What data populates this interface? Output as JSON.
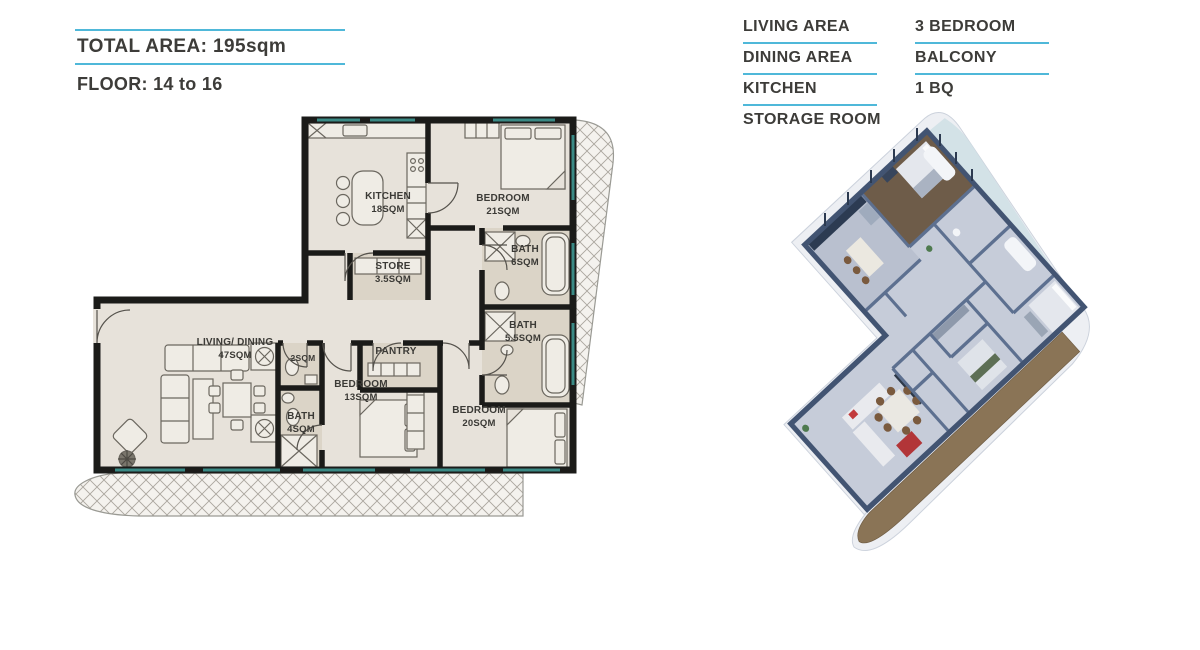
{
  "header": {
    "total_area": "TOTAL AREA: 195sqm",
    "floor": "FLOOR: 14 to 16"
  },
  "legend": {
    "column1": [
      "LIVING AREA",
      "DINING AREA",
      "KITCHEN",
      "STORAGE ROOM"
    ],
    "column2": [
      "3 BEDROOM",
      "BALCONY",
      "1 BQ"
    ]
  },
  "floorplan": {
    "rooms": [
      {
        "id": "kitchen",
        "name": "KITCHEN",
        "area": "18SQM"
      },
      {
        "id": "bedroom-1",
        "name": "BEDROOM",
        "area": "21SQM"
      },
      {
        "id": "store",
        "name": "STORE",
        "area": "3.5SQM"
      },
      {
        "id": "bath-1",
        "name": "BATH",
        "area": "6SQM"
      },
      {
        "id": "bath-2",
        "name": "BATH",
        "area": "5.5SQM"
      },
      {
        "id": "living-dining",
        "name": "LIVING/ DINING",
        "area": "47SQM"
      },
      {
        "id": "wc",
        "name": "2SQM",
        "area": ""
      },
      {
        "id": "bath-3",
        "name": "BATH",
        "area": "4SQM"
      },
      {
        "id": "pantry",
        "name": "PANTRY",
        "area": ""
      },
      {
        "id": "bedroom-2",
        "name": "BEDROOM",
        "area": "13SQM"
      },
      {
        "id": "bedroom-3",
        "name": "BEDROOM",
        "area": "20SQM"
      }
    ]
  },
  "colors": {
    "accent_cyan": "#4fb8d9",
    "text": "#3d3c39",
    "wall": "#1b1b19",
    "floor_beige": "#e7e2da",
    "wet_room": "#dbd4c7",
    "window_teal": "#3a8a85",
    "render_wall_dark": "#425472",
    "render_wall": "#5d7090",
    "render_floor": "#c6ccd9",
    "render_wood": "#6e5c49",
    "deck_brown": "#8a7456",
    "accent_red": "#c23a3c"
  }
}
